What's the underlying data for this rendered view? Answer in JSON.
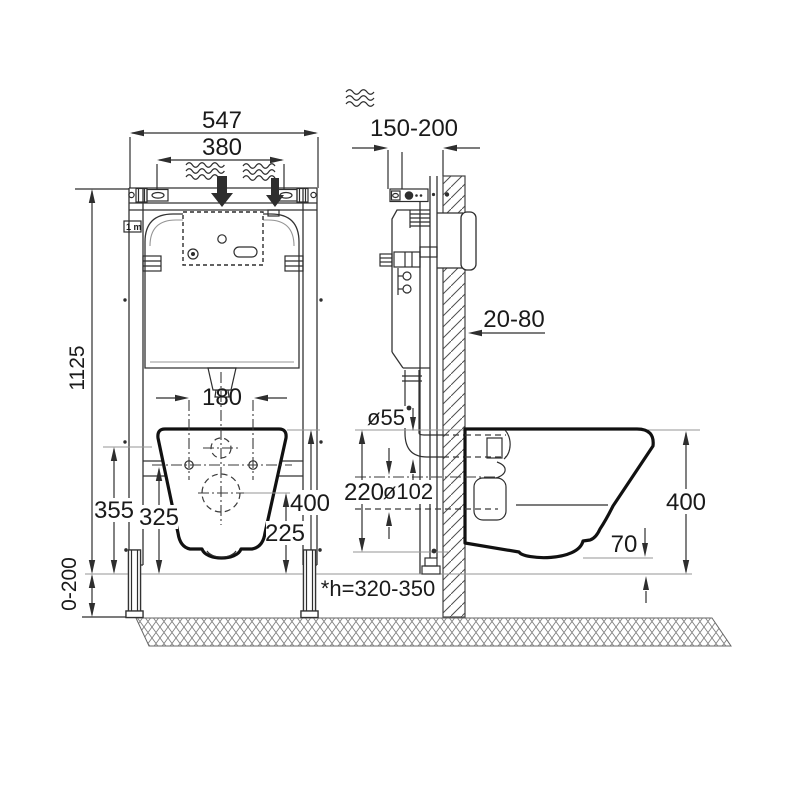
{
  "diagram": {
    "labels": {
      "overall_width": "547",
      "top_mount_width": "380",
      "frame_height": "1125",
      "frame_depth": "150-200",
      "bolt_spacing": "180",
      "flush_inlet_height": "355",
      "bolt_height": "325",
      "bowl_top_height_front": "400",
      "drain_height": "225",
      "wall_finish_range": "20-80",
      "flush_pipe_diameter": "ø55",
      "pipe_span": "220",
      "drain_diameter": "ø102",
      "bowl_top_height_side": "400",
      "bowl_bottom_clearance": "70",
      "leg_adjustment": "0-200",
      "drain_rough_in_note": "*h=320-350",
      "meter_mark": "1 m"
    },
    "colors": {
      "line": "#2e2e2e",
      "outline": "#111111",
      "light_line": "#949494",
      "background": "#ffffff"
    }
  }
}
